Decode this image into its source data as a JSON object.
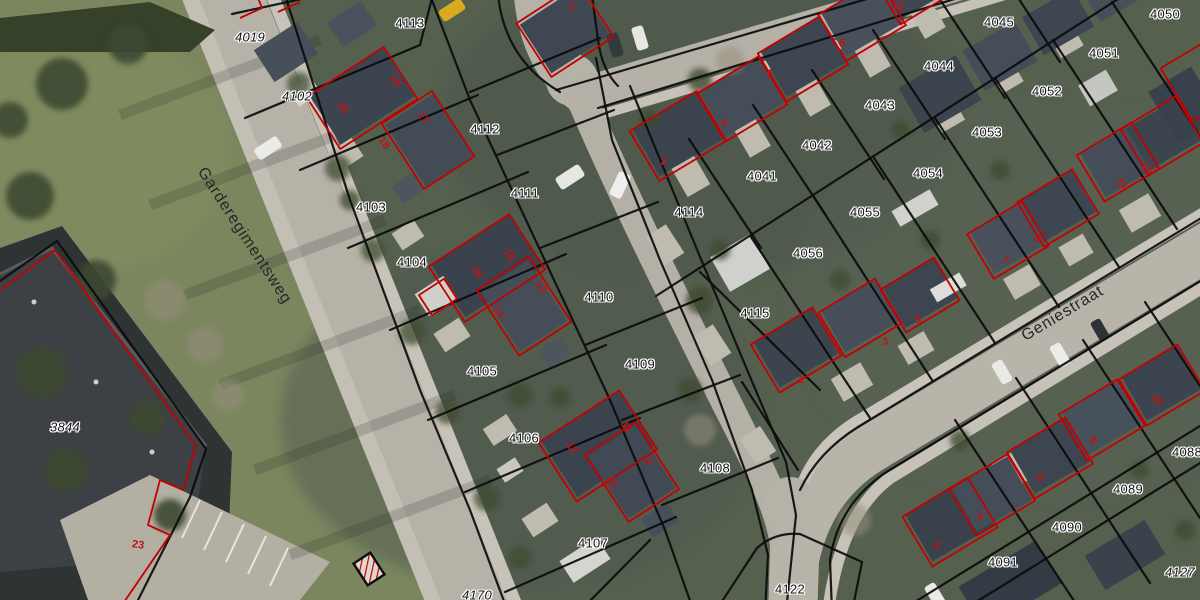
{
  "map_view": {
    "streets": [
      {
        "name": "Garderegimentsweg",
        "x": 244,
        "y": 236,
        "rotation": 57
      },
      {
        "name": "Geniestraat",
        "x": 1063,
        "y": 314,
        "rotation": -31
      }
    ],
    "parcel_labels": [
      {
        "text": "4019",
        "x": 250,
        "y": 37,
        "italic": true
      },
      {
        "text": "4102",
        "x": 297,
        "y": 96,
        "italic": true
      },
      {
        "text": "4113",
        "x": 410,
        "y": 23,
        "italic": false
      },
      {
        "text": "4112",
        "x": 485,
        "y": 129,
        "italic": false
      },
      {
        "text": "4111",
        "x": 525,
        "y": 193,
        "italic": false
      },
      {
        "text": "4103",
        "x": 371,
        "y": 207,
        "italic": false
      },
      {
        "text": "4104",
        "x": 412,
        "y": 262,
        "italic": false
      },
      {
        "text": "4110",
        "x": 599,
        "y": 297,
        "italic": false
      },
      {
        "text": "4114",
        "x": 689,
        "y": 212,
        "italic": false
      },
      {
        "text": "4115",
        "x": 755,
        "y": 313,
        "italic": false
      },
      {
        "text": "4109",
        "x": 640,
        "y": 364,
        "italic": false
      },
      {
        "text": "4105",
        "x": 482,
        "y": 371,
        "italic": false
      },
      {
        "text": "4106",
        "x": 524,
        "y": 438,
        "italic": false
      },
      {
        "text": "4108",
        "x": 715,
        "y": 468,
        "italic": false
      },
      {
        "text": "4107",
        "x": 593,
        "y": 543,
        "italic": false
      },
      {
        "text": "4170",
        "x": 477,
        "y": 595,
        "italic": true
      },
      {
        "text": "4122",
        "x": 790,
        "y": 589,
        "italic": false
      },
      {
        "text": "4041",
        "x": 762,
        "y": 176,
        "italic": false
      },
      {
        "text": "4042",
        "x": 817,
        "y": 145,
        "italic": false
      },
      {
        "text": "4043",
        "x": 880,
        "y": 105,
        "italic": false
      },
      {
        "text": "4044",
        "x": 939,
        "y": 66,
        "italic": false
      },
      {
        "text": "4045",
        "x": 999,
        "y": 22,
        "italic": false
      },
      {
        "text": "4050",
        "x": 1165,
        "y": 14,
        "italic": false
      },
      {
        "text": "4051",
        "x": 1104,
        "y": 53,
        "italic": false
      },
      {
        "text": "4052",
        "x": 1047,
        "y": 91,
        "italic": false
      },
      {
        "text": "4053",
        "x": 987,
        "y": 132,
        "italic": false
      },
      {
        "text": "4054",
        "x": 928,
        "y": 173,
        "italic": false
      },
      {
        "text": "4055",
        "x": 865,
        "y": 212,
        "italic": false
      },
      {
        "text": "4056",
        "x": 808,
        "y": 253,
        "italic": false
      },
      {
        "text": "4089",
        "x": 1128,
        "y": 489,
        "italic": false
      },
      {
        "text": "4090",
        "x": 1067,
        "y": 527,
        "italic": false
      },
      {
        "text": "4091",
        "x": 1003,
        "y": 562,
        "italic": false
      },
      {
        "text": "4088",
        "x": 1187,
        "y": 452,
        "italic": false
      },
      {
        "text": "4127",
        "x": 1180,
        "y": 572,
        "italic": true
      },
      {
        "text": "3844",
        "x": 65,
        "y": 427,
        "italic": true
      }
    ],
    "house_numbers": [
      {
        "text": "20",
        "x": 343,
        "y": 108,
        "rotation": 55
      },
      {
        "text": "19",
        "x": 395,
        "y": 81,
        "rotation": 55
      },
      {
        "text": "18",
        "x": 384,
        "y": 143,
        "rotation": 55
      },
      {
        "text": "17",
        "x": 423,
        "y": 118,
        "rotation": 55
      },
      {
        "text": "16",
        "x": 477,
        "y": 272,
        "rotation": 55
      },
      {
        "text": "15",
        "x": 509,
        "y": 255,
        "rotation": 55
      },
      {
        "text": "14",
        "x": 498,
        "y": 312,
        "rotation": 55
      },
      {
        "text": "13",
        "x": 541,
        "y": 287,
        "rotation": 55
      },
      {
        "text": "12",
        "x": 572,
        "y": 448,
        "rotation": 55
      },
      {
        "text": "11",
        "x": 626,
        "y": 427,
        "rotation": 55
      },
      {
        "text": "10",
        "x": 611,
        "y": 482,
        "rotation": 55
      },
      {
        "text": "9",
        "x": 648,
        "y": 462,
        "rotation": 55
      },
      {
        "text": "1",
        "x": 572,
        "y": 7,
        "rotation": 30
      },
      {
        "text": "2",
        "x": 664,
        "y": 162,
        "rotation": 10
      },
      {
        "text": "4",
        "x": 724,
        "y": 123,
        "rotation": 10
      },
      {
        "text": "6",
        "x": 770,
        "y": 74,
        "rotation": 10
      },
      {
        "text": "8",
        "x": 842,
        "y": 43,
        "rotation": 10
      },
      {
        "text": "10",
        "x": 898,
        "y": 6,
        "rotation": 10
      },
      {
        "text": "1",
        "x": 801,
        "y": 380,
        "rotation": 0
      },
      {
        "text": "3",
        "x": 885,
        "y": 342,
        "rotation": 0
      },
      {
        "text": "5",
        "x": 918,
        "y": 320,
        "rotation": 0
      },
      {
        "text": "7",
        "x": 1005,
        "y": 260,
        "rotation": 40
      },
      {
        "text": "9",
        "x": 1037,
        "y": 239,
        "rotation": 40
      },
      {
        "text": "11",
        "x": 1122,
        "y": 184,
        "rotation": 40
      },
      {
        "text": "13",
        "x": 1147,
        "y": 168,
        "rotation": 40
      },
      {
        "text": "2",
        "x": 937,
        "y": 546,
        "rotation": 28
      },
      {
        "text": "4",
        "x": 980,
        "y": 517,
        "rotation": 28
      },
      {
        "text": "6",
        "x": 1040,
        "y": 478,
        "rotation": 28
      },
      {
        "text": "8",
        "x": 1093,
        "y": 441,
        "rotation": 28
      },
      {
        "text": "10",
        "x": 1157,
        "y": 400,
        "rotation": 40
      },
      {
        "text": "23",
        "x": 138,
        "y": 545,
        "rotation": 8
      }
    ],
    "palette": {
      "parcel_boundary": "#0b0b0b",
      "building_outline": "#c40000",
      "house_number_text": "#c01414",
      "parcel_label_text": "#141414",
      "parcel_label_halo": "#ffffff",
      "road": "#b6b2a8",
      "sidewalk": "#c8c4ba",
      "grass": "#7b865f",
      "roof_dark": "#3c454f"
    }
  }
}
